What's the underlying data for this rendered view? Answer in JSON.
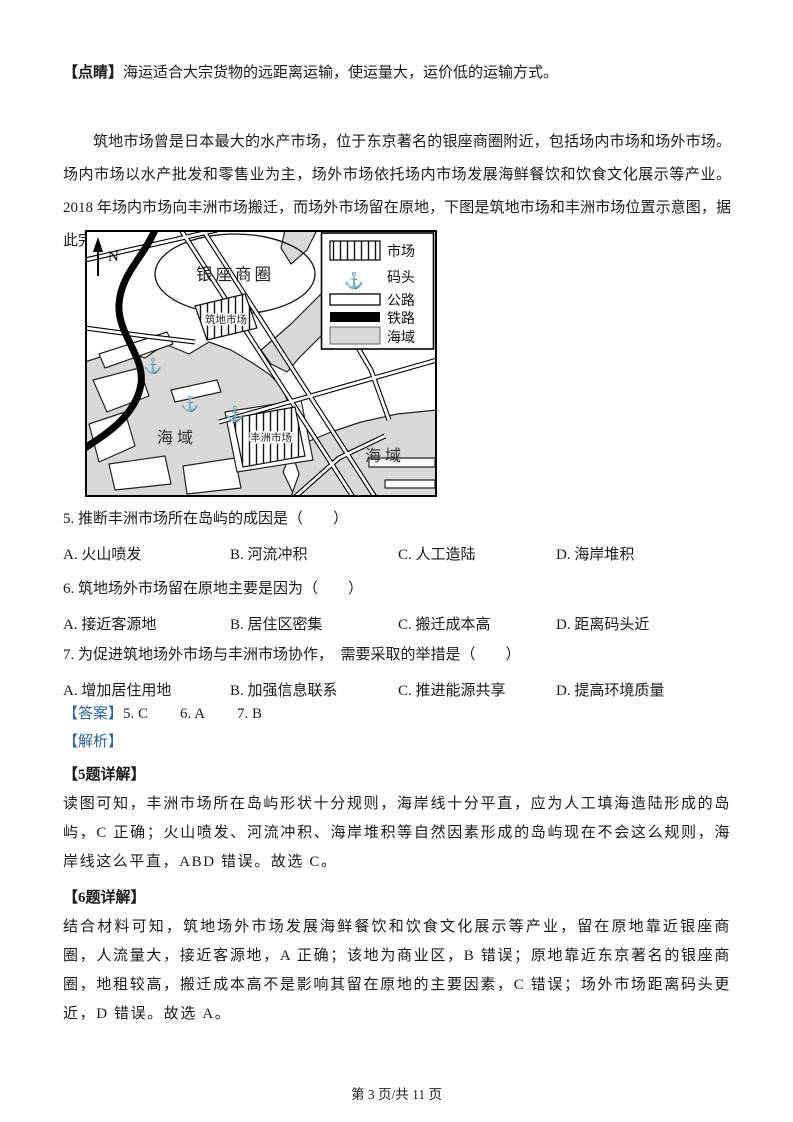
{
  "note": {
    "label": "【点睛】",
    "text": "海运适合大宗货物的远距离运输，使运量大，运价低的运输方式。"
  },
  "passage": "筑地市场曾是日本最大的水产市场，位于东京著名的银座商圈附近，包括场内市场和场外市场。场内市场以水产批发和零售业为主，场外市场依托场内市场发展海鲜餐饮和饮食文化展示等产业。2018 年场内市场向丰洲市场搬迁，而场外市场留在原地，下图是筑地市场和丰洲市场位置示意图，据此完成下面小题。",
  "map": {
    "north_label": "N",
    "anchor_glyph": "⚓",
    "labels": {
      "ginza": "银座商圈",
      "tsukiji": "筑地市场",
      "toyosu": "丰洲市场",
      "sea1": "海域",
      "sea2": "海域"
    },
    "legend": {
      "items": [
        {
          "key": "market",
          "label": "市场"
        },
        {
          "key": "dock",
          "label": "码头"
        },
        {
          "key": "road",
          "label": "公路"
        },
        {
          "key": "railway",
          "label": "铁路"
        },
        {
          "key": "sea",
          "label": "海域"
        }
      ]
    },
    "colors": {
      "sea": "#d9d9d9",
      "land": "#ffffff",
      "line": "#000000"
    }
  },
  "questions": [
    {
      "number": "5.",
      "stem": "推断丰洲市场所在岛屿的成因是（　　）",
      "options": [
        "A. 火山喷发",
        "B. 河流冲积",
        "C. 人工造陆",
        "D. 海岸堆积"
      ]
    },
    {
      "number": "6.",
      "stem": "筑地场外市场留在原地主要是因为（　　）",
      "options": [
        "A. 接近客源地",
        "B. 居住区密集",
        "C. 搬迁成本高",
        "D. 距离码头近"
      ]
    },
    {
      "number": "7.",
      "stem": "为促进筑地场外市场与丰洲市场协作，　需要采取的举措是（　　）",
      "options": [
        "A. 增加居住用地",
        "B. 加强信息联系",
        "C. 推进能源共享",
        "D. 提高环境质量"
      ]
    }
  ],
  "answers": {
    "label": "【答案】",
    "items": [
      "5. C",
      "6. A",
      "7. B"
    ]
  },
  "analysis": {
    "label": "【解析】",
    "sections": [
      {
        "head": "【5题详解】",
        "text": "读图可知，丰洲市场所在岛屿形状十分规则，海岸线十分平直，应为人工填海造陆形成的岛屿，C 正确；火山喷发、河流冲积、海岸堆积等自然因素形成的岛屿现在不会这么规则，海岸线这么平直，ABD 错误。故选 C。"
      },
      {
        "head": "【6题详解】",
        "text": "结合材料可知，筑地场外市场发展海鲜餐饮和饮食文化展示等产业，留在原地靠近银座商圈，人流量大，接近客源地，A 正确；该地为商业区，B 错误；原地靠近东京著名的银座商圈，地租较高，搬迁成本高不是影响其留在原地的主要因素，C 错误；场外市场距离码头更近，D 错误。故选 A。"
      }
    ]
  },
  "page": {
    "footer": "第 3 页/共 11 页"
  },
  "colors": {
    "accent_blue": "#2e6496"
  }
}
